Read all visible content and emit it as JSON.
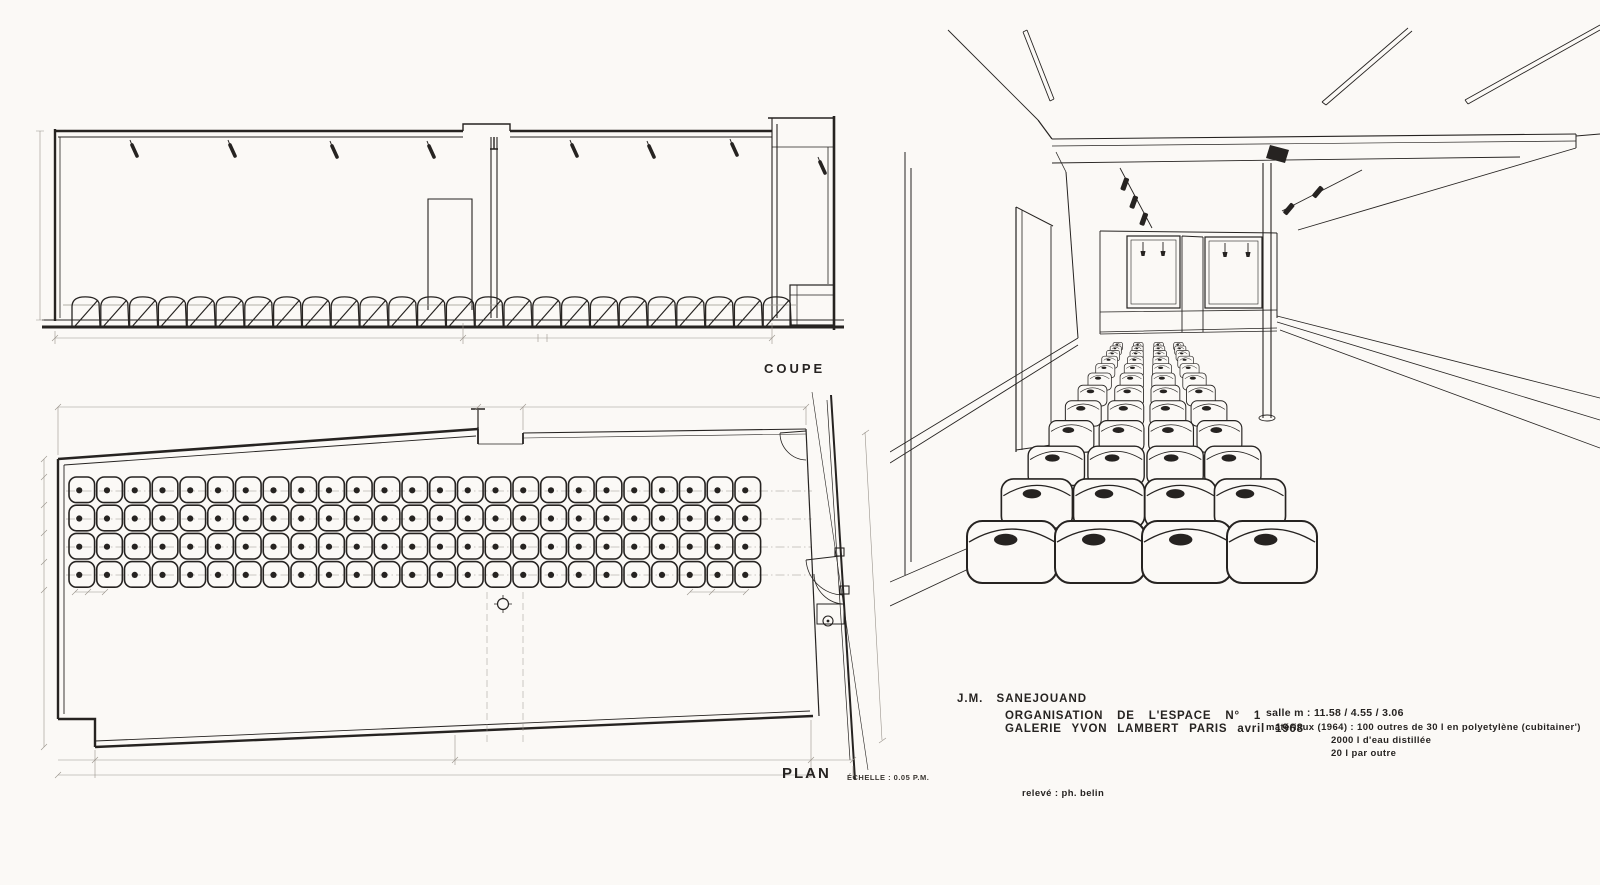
{
  "colors": {
    "paper": "#fbf9f6",
    "ink": "#262321",
    "pencil": "#9a948c"
  },
  "coupe": {
    "label": "COUPE",
    "container_count": 25,
    "spotlight_count": 8
  },
  "plan": {
    "label": "PLAN",
    "scale_note": "ÉCHELLE : 0.05 P.M.",
    "grid_rows": 4,
    "grid_cols": 25,
    "container_total": 100
  },
  "perspective": {
    "container_columns": 4,
    "container_rows": 12,
    "window_pendants": 4,
    "track_spotlights": 5
  },
  "caption": {
    "artist": "J.M.  SANEJOUAND",
    "title_line1": "ORGANISATION  DE  L'ESPACE  N° 1",
    "title_line2": "GALERIE  YVON  LAMBERT  PARIS  avril  1968",
    "salle": "salle m : 11.58 / 4.55 / 3.06",
    "materiaux_line1": "matériaux (1964) : 100 outres  de 30 l  en  polyetylène (cubitainer')",
    "materiaux_line2": "2000 l  d'eau  distillée",
    "materiaux_line3": "20 l  par  outre",
    "credit": "relevé : ph. belin"
  }
}
